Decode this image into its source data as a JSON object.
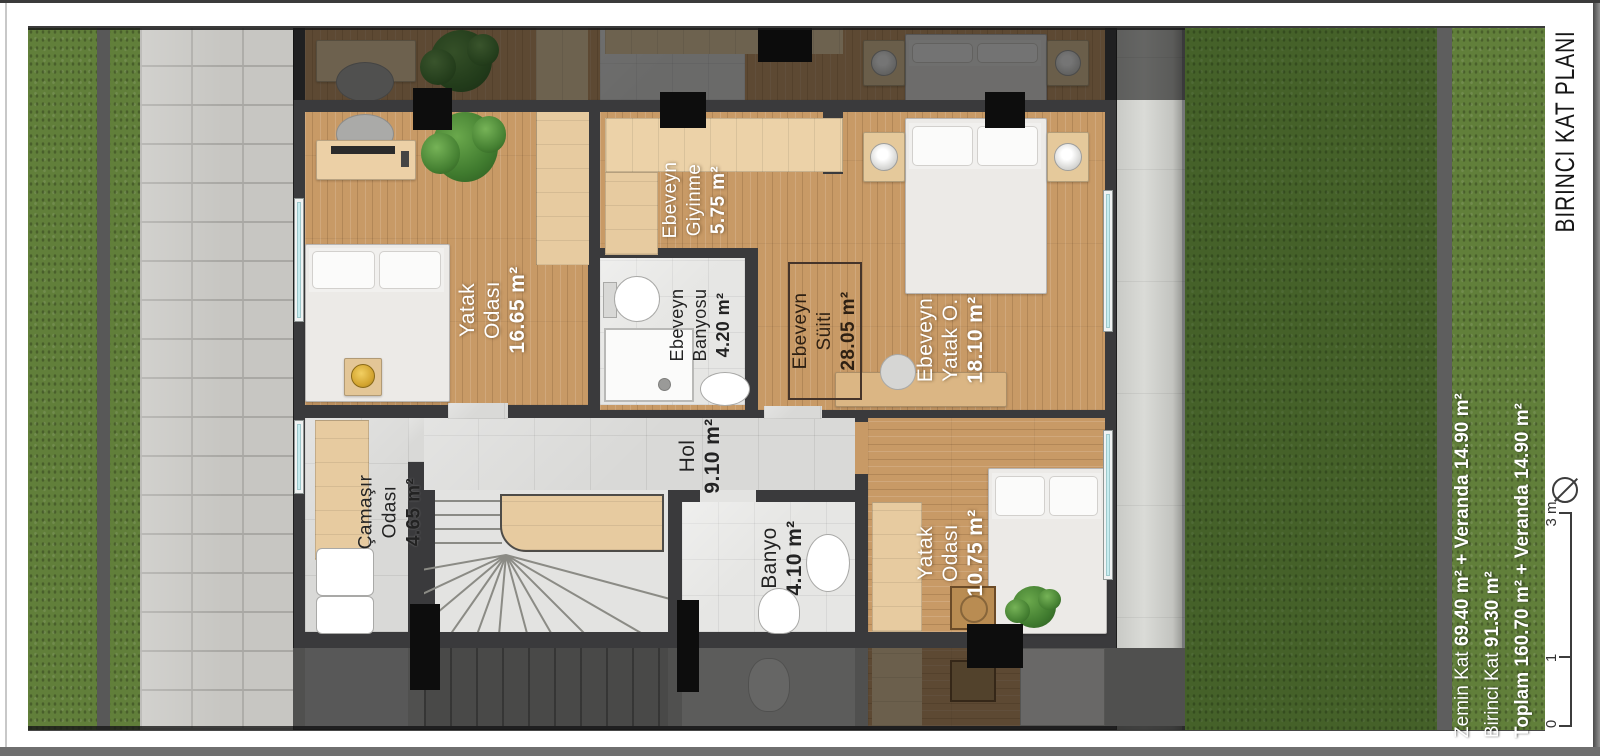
{
  "plan": {
    "title": "BIRINCI KAT PLANI",
    "rooms": [
      {
        "id": "yatak-odasi-1",
        "line1": "Yatak",
        "line2": "Odası",
        "area": "16.65 m²"
      },
      {
        "id": "ebeveyn-giyinme",
        "line1": "Ebeveyn",
        "line2": "Giyinme",
        "area": "5.75 m²"
      },
      {
        "id": "ebeveyn-banyosu",
        "line1": "Ebeveyn",
        "line2": "Banyosu",
        "area": "4.20 m²"
      },
      {
        "id": "ebeveyn-suiti",
        "line1": "Ebeveyn",
        "line2": "Süiti",
        "area": "28.05 m²"
      },
      {
        "id": "ebeveyn-yatak-odasi",
        "line1": "Ebeveyn",
        "line2": "Yatak O.",
        "area": "18.10 m²"
      },
      {
        "id": "camasir-odasi",
        "line1": "Çamaşır",
        "line2": "Odası",
        "area": "4.65 m²"
      },
      {
        "id": "hol",
        "line1": "Hol",
        "line2": "",
        "area": "9.10 m²"
      },
      {
        "id": "banyo",
        "line1": "Banyo",
        "line2": "",
        "area": "4.10 m²"
      },
      {
        "id": "yatak-odasi-2",
        "line1": "Yatak",
        "line2": "Odası",
        "area": "10.75 m²"
      }
    ],
    "summary": [
      {
        "label": "Zemin Kat",
        "value": "69.40 m² + Veranda 14.90 m²"
      },
      {
        "label": "Birinci Kat",
        "value": "91.30 m²"
      },
      {
        "label": "Toplam",
        "value": "160.70 m² + Veranda 14.90 m²"
      }
    ],
    "scale": {
      "labels": [
        "0",
        "1",
        "3 m"
      ]
    },
    "icons": {
      "north": "north-arrow"
    },
    "colors": {
      "wall": "#3a3a3c",
      "wood": "#c89a66",
      "wood_light": "#ecd2a8",
      "tile": "#e6e6e4",
      "grass": "#617f3a",
      "window_glass": "#c7edf0",
      "pavement": "#c7c6c2",
      "label_light": "#ffffff",
      "label_dark": "#232323"
    }
  }
}
